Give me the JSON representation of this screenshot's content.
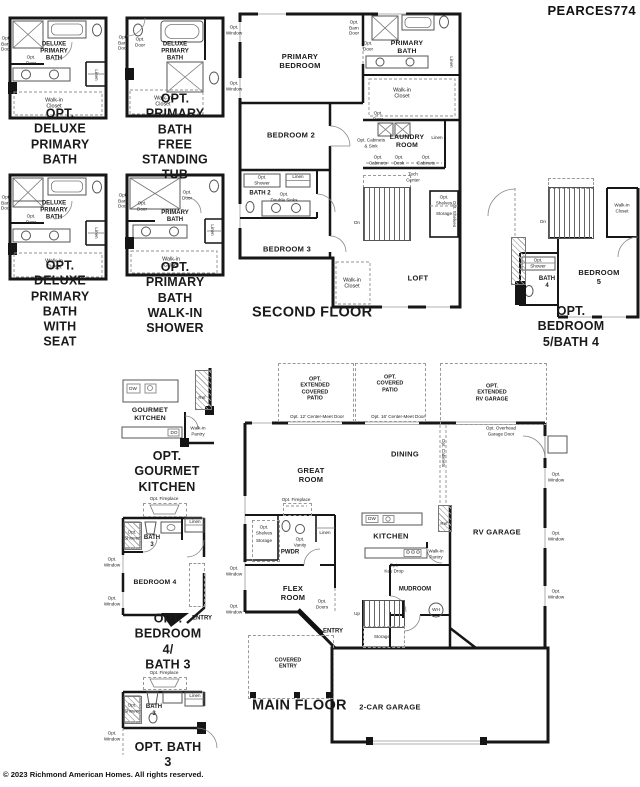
{
  "header": {
    "plan_code": "PEARCES774"
  },
  "footer": {
    "copyright": "© 2023 Richmond American Homes. All rights reserved."
  },
  "insets": {
    "deluxe_primary_bath": {
      "caption": "OPT. DELUXE\nPRIMARY BATH",
      "labels": {
        "room": "DELUXE\nPRIMARY\nBATH",
        "opt_barn_door": "Opt.\nBarn\nDoor",
        "opt_door": "Opt.\nDoor",
        "linen": "Linen",
        "walk_in_closet": "Walk-in\nCloset"
      }
    },
    "free_standing_tub": {
      "caption": "OPT. PRIMARY BATH\nFREE STANDING TUB",
      "labels": {
        "room": "DELUXE\nPRIMARY\nBATH",
        "opt_barn_door": "Opt.\nBarn\nDoor",
        "opt_door": "Opt.\nDoor",
        "walk_in_closet": "Walk-in\nCloset"
      }
    },
    "deluxe_with_seat": {
      "caption": "OPT. DELUXE\nPRIMARY BATH\nWITH SEAT",
      "labels": {
        "room": "DELUXE\nPRIMARY\nBATH",
        "opt_barn_door": "Opt.\nBarn\nDoor",
        "opt_door": "Opt.\nDoor",
        "linen": "Linen",
        "walk_in_closet": "Walk-in\nCloset"
      }
    },
    "walk_in_shower": {
      "caption": "OPT. PRIMARY BATH\nWALK-IN SHOWER",
      "labels": {
        "room": "PRIMARY\nBATH",
        "opt_barn_door": "Opt.\nBarn\nDoor",
        "opt_door": "Opt.\nDoor",
        "opt_door_2": "Opt.\nDoor",
        "linen": "Linen",
        "walk_in_closet": "Walk-in\nCloset"
      }
    },
    "bedroom5_bath4": {
      "caption": "OPT. BEDROOM 5/BATH 4",
      "labels": {
        "bedroom5": "BEDROOM 5",
        "bath4": "BATH\n4",
        "opt_shower": "Opt.\nShower",
        "walk_in_closet": "Walk-in\nCloset",
        "dn": "Dn"
      }
    },
    "gourmet_kitchen": {
      "caption": "OPT. GOURMET\nKITCHEN",
      "labels": {
        "room": "GOURMET\nKITCHEN",
        "dw": "DW",
        "double_oven": "DO",
        "ref": "Ref",
        "walk_in_pantry": "Walk-in\nPantry"
      }
    },
    "bedroom4_bath3": {
      "caption": "OPT. BEDROOM 4/\nBATH 3",
      "labels": {
        "opt_fireplace": "Opt. Fireplace",
        "opt_shower": "Opt.\nShower",
        "bath": "BATH\n3",
        "linen": "Linen",
        "bedroom": "BEDROOM 4",
        "opt_window_1": "Opt.\nWindow",
        "opt_window_2": "Opt.\nWindow",
        "entry": "ENTRY"
      }
    },
    "bath3": {
      "caption": "OPT. BATH 3",
      "labels": {
        "opt_fireplace": "Opt. Fireplace",
        "opt_shower": "Opt.\nShower",
        "bath": "BATH\n3",
        "linen": "Linen",
        "opt_window": "Opt.\nWindow"
      }
    }
  },
  "second_floor": {
    "title": "SECOND FLOOR",
    "labels": {
      "primary_bedroom": "PRIMARY\nBEDROOM",
      "primary_bath": "PRIMARY\nBATH",
      "bedroom2": "BEDROOM 2",
      "bedroom3": "BEDROOM 3",
      "bath2": "BATH 2",
      "laundry": "LAUNDRY\nROOM",
      "loft": "LOFT",
      "walk_in_closet": "Walk-in\nCloset",
      "walk_in_closet_2": "Walk-in\nCloset",
      "linen_primary": "Linen",
      "linen_laundry": "Linen",
      "linen_bath2": "Linen",
      "opt_window_1": "Opt.\nWindow",
      "opt_window_2": "Opt.\nWindow",
      "opt_barn_door": "Opt.\nBarn\nDoor",
      "opt_door_bath": "Opt.\nDoor",
      "opt_door_laundry": "Opt.\nDoor",
      "opt_cabinets_sink": "Opt. Cabinets\n& Sink",
      "opt_cabinets_left": "Opt.\nCabinets",
      "opt_desk": "Opt.\nDesk",
      "opt_cabinets_right": "Opt.\nCabinets",
      "tech_center": "Tech\nCenter",
      "opt_shower": "Opt.\nShower",
      "opt_double_sinks": "Opt.\nDouble Sinks",
      "dn": "Dn",
      "opt_shelves": "Opt.\nShelves",
      "storage": "Storage",
      "opt_shelves_vert": "Opt. Shelves"
    }
  },
  "main_floor": {
    "title": "MAIN FLOOR",
    "labels": {
      "opt_extended_covered_patio": "OPT.\nEXTENDED\nCOVERED\nPATIO",
      "opt_covered_patio": "OPT.\nCOVERED\nPATIO",
      "opt_extended_rv_garage": "OPT.\nEXTENDED\nRV GARAGE",
      "door_12": "Opt. 12' Center-Meet Door",
      "door_16": "Opt. 16' Center-Meet Door",
      "great_room": "GREAT\nROOM",
      "dining": "DINING",
      "opt_cabinets": "Opt. Cabinets",
      "rv_garage": "RV GARAGE",
      "opt_overhead_garage_door": "Opt. Overhead\nGarage Door",
      "opt_window_r1": "Opt.\nWindow",
      "opt_window_r2": "Opt.\nWindow",
      "opt_window_r3": "Opt.\nWindow",
      "opt_window_l1": "Opt.\nWindow",
      "opt_window_l2": "Opt.\nWindow",
      "opt_fireplace": "Opt. Fireplace",
      "opt_shelves": "Opt.\nShelves",
      "storage_closet": "Storage",
      "pwdr": "PWDR",
      "opt_vanity": "Opt.\nVanity",
      "linen": "Linen",
      "kitchen": "KITCHEN",
      "dw": "DW",
      "ref": "Ref",
      "walk_in_pantry": "Walk-in\nPantry",
      "opt_key_drop": "Opt.\nKey Drop",
      "mudroom": "MUDROOM",
      "wh": "WH",
      "flex_room": "FLEX\nROOM",
      "opt_doors": "Opt.\nDoors",
      "entry": "ENTRY",
      "up": "Up",
      "storage_stairs": "Storage",
      "covered_entry": "COVERED\nENTRY",
      "two_car_garage": "2-CAR GARAGE"
    }
  }
}
